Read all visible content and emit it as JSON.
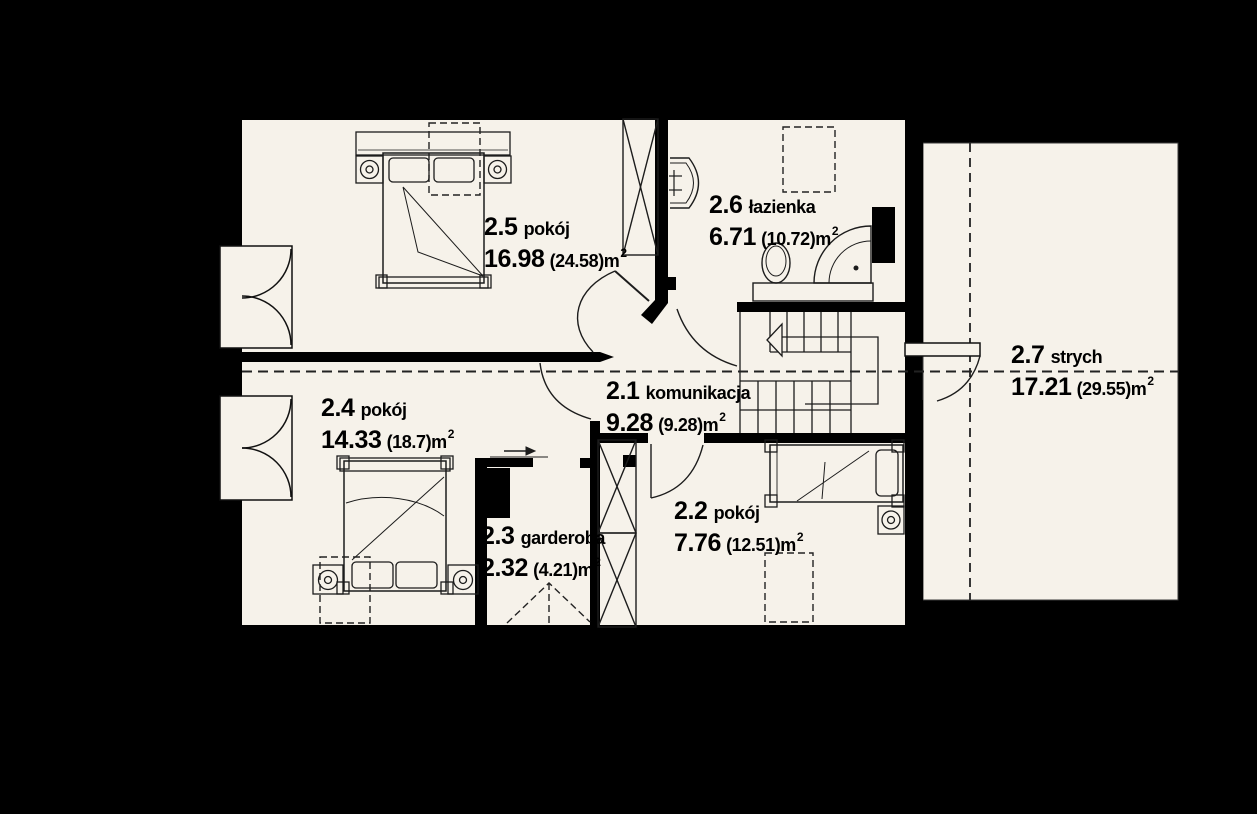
{
  "title": "floor-plan-upper-storey",
  "colors": {
    "background": "#000000",
    "floor": "#f6f2ea",
    "wall": "#000000",
    "line": "#1c1c1c"
  },
  "rooms": [
    {
      "id": "2.5",
      "name": "pokój",
      "area": "16.98",
      "gross": "(24.58)m",
      "sup": "2"
    },
    {
      "id": "2.6",
      "name": "łazienka",
      "area": "6.71",
      "gross": "(10.72)m",
      "sup": "2"
    },
    {
      "id": "2.1",
      "name": "komunikacja",
      "area": "9.28",
      "gross": "(9.28)m",
      "sup": "2"
    },
    {
      "id": "2.7",
      "name": "strych",
      "area": "17.21",
      "gross": "(29.55)m",
      "sup": "2"
    },
    {
      "id": "2.4",
      "name": "pokój",
      "area": "14.33",
      "gross": "(18.7)m",
      "sup": "2"
    },
    {
      "id": "2.3",
      "name": "garderoba",
      "area": "2.32",
      "gross": "(4.21)m",
      "sup": "2"
    },
    {
      "id": "2.2",
      "name": "pokój",
      "area": "7.76",
      "gross": "(12.51)m",
      "sup": "2"
    }
  ]
}
